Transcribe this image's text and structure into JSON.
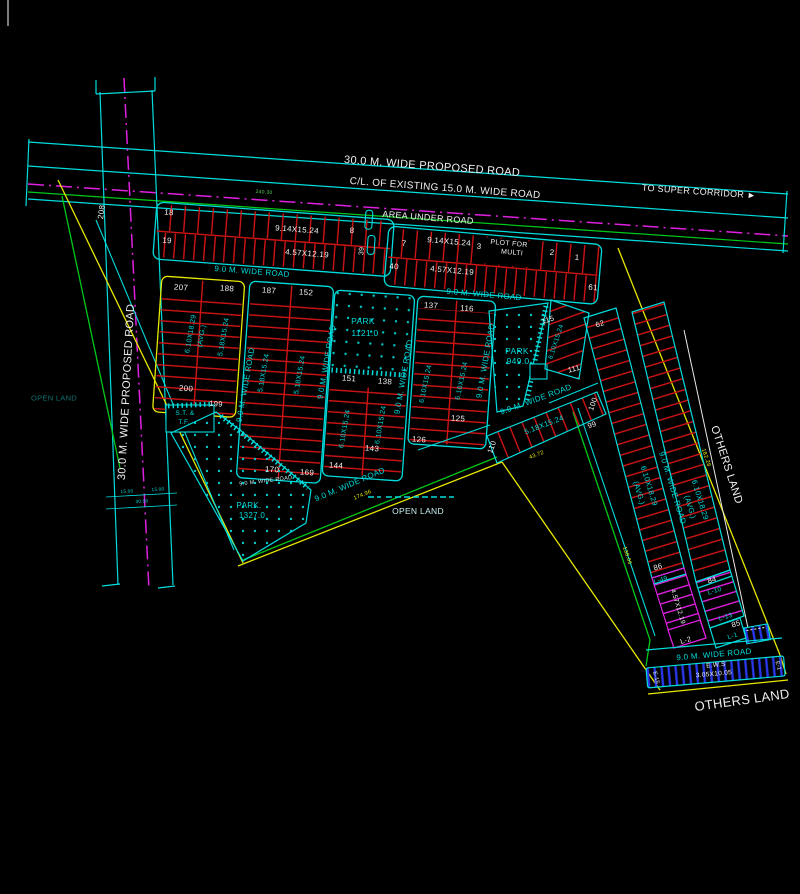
{
  "canvas": {
    "width": 800,
    "height": 894,
    "background": "#000000"
  },
  "colors": {
    "cyan": "#00dcdc",
    "red": "#d01414",
    "yellow": "#e8e800",
    "green": "#00c818",
    "magenta": "#e020e0",
    "blue": "#2838e8",
    "white": "#f0f0f0",
    "pale_cyan": "#c8f0f0",
    "dim_teal": "#127272",
    "dim_green": "#50d050"
  },
  "labels": [
    {
      "name": "road-proposed-label",
      "text": "30.0 M. WIDE PROPOSED ROAD",
      "x": 432,
      "y": 167,
      "rot": 4.3,
      "size": 11,
      "color": "#f0f0f0"
    },
    {
      "name": "road-existing-label",
      "text": "C/L. OF EXISTING 15.0 M. WIDE ROAD",
      "x": 445,
      "y": 189,
      "rot": 4.3,
      "size": 10,
      "color": "#f0f0f0"
    },
    {
      "name": "to-super-corridor-label",
      "text": "TO SUPER CORRIDOR ►",
      "x": 699,
      "y": 192,
      "rot": 4,
      "size": 9,
      "color": "#f0f0f0"
    },
    {
      "name": "dim-240-30",
      "text": "240.30",
      "x": 264,
      "y": 193,
      "rot": 4,
      "size": 5,
      "color": "#50d050"
    },
    {
      "name": "plot-208",
      "text": "208",
      "x": 102,
      "y": 212,
      "rot": -82,
      "size": 8,
      "color": "#f0f0f0"
    },
    {
      "name": "area-under-road-label",
      "text": "AREA UNDER ROAD",
      "x": 428,
      "y": 218,
      "rot": 4.5,
      "size": 9,
      "color": "#f0f0f0"
    },
    {
      "name": "plot-18",
      "text": "18",
      "x": 169,
      "y": 213,
      "rot": 4,
      "size": 8,
      "color": "#f0f0f0"
    },
    {
      "name": "plot-19",
      "text": "19",
      "x": 167,
      "y": 241,
      "rot": 4,
      "size": 8,
      "color": "#f0f0f0"
    },
    {
      "name": "dim-914x1524-a",
      "text": "9.14X15.24",
      "x": 297,
      "y": 230,
      "rot": 4.3,
      "size": 8,
      "color": "#f0f0f0"
    },
    {
      "name": "dim-457x1219-a",
      "text": "4.57X12.19",
      "x": 307,
      "y": 254,
      "rot": 4.3,
      "size": 8,
      "color": "#f0f0f0"
    },
    {
      "name": "plot-8",
      "text": "8",
      "x": 352,
      "y": 231,
      "rot": 4,
      "size": 8,
      "color": "#f0f0f0"
    },
    {
      "name": "plot-39",
      "text": "39",
      "x": 362,
      "y": 251,
      "rot": -86,
      "size": 7,
      "color": "#f0f0f0"
    },
    {
      "name": "road-90-tl",
      "text": "9.0 M. WIDE ROAD",
      "x": 252,
      "y": 272,
      "rot": 4.5,
      "size": 8,
      "color": "#00dcdc"
    },
    {
      "name": "plot-7",
      "text": "7",
      "x": 404,
      "y": 244,
      "rot": 5,
      "size": 8,
      "color": "#f0f0f0"
    },
    {
      "name": "dim-914x1524-b",
      "text": "9.14X15.24",
      "x": 449,
      "y": 242,
      "rot": 5,
      "size": 8,
      "color": "#f0f0f0"
    },
    {
      "name": "plot-3",
      "text": "3",
      "x": 479,
      "y": 247,
      "rot": 5,
      "size": 8,
      "color": "#f0f0f0"
    },
    {
      "name": "plot-for-multi-line1",
      "text": "PLOT FOR",
      "x": 509,
      "y": 244,
      "rot": 5,
      "size": 7,
      "color": "#f0f0f0"
    },
    {
      "name": "plot-for-multi-line2",
      "text": "MULTI",
      "x": 512,
      "y": 253,
      "rot": 5,
      "size": 7,
      "color": "#f0f0f0"
    },
    {
      "name": "plot-2",
      "text": "2",
      "x": 552,
      "y": 253,
      "rot": 5,
      "size": 8,
      "color": "#f0f0f0"
    },
    {
      "name": "plot-1",
      "text": "1",
      "x": 577,
      "y": 258,
      "rot": 5,
      "size": 8,
      "color": "#f0f0f0"
    },
    {
      "name": "plot-40",
      "text": "40",
      "x": 394,
      "y": 267,
      "rot": 5,
      "size": 8,
      "color": "#f0f0f0"
    },
    {
      "name": "dim-457x1219-b",
      "text": "4.57X12.19",
      "x": 452,
      "y": 271,
      "rot": 5,
      "size": 8,
      "color": "#f0f0f0"
    },
    {
      "name": "plot-61",
      "text": "61",
      "x": 593,
      "y": 288,
      "rot": 5,
      "size": 8,
      "color": "#f0f0f0"
    },
    {
      "name": "road-90-tr",
      "text": "9.0 M. WIDE ROAD",
      "x": 484,
      "y": 295,
      "rot": 5,
      "size": 8,
      "color": "#00dcdc"
    },
    {
      "name": "road-proposed-left-label",
      "text": "30.0 M. WIDE PROPOSED ROAD",
      "x": 127,
      "y": 392,
      "rot": -87,
      "size": 11,
      "color": "#f0f0f0"
    },
    {
      "name": "open-land-left-label",
      "text": "OPEN LAND",
      "x": 54,
      "y": 398,
      "rot": 0,
      "size": 7.5,
      "color": "#127272"
    },
    {
      "name": "dim-15-00-a",
      "text": "15.00",
      "x": 127,
      "y": 492,
      "rot": -3,
      "size": 4.5,
      "color": "#00dcdc"
    },
    {
      "name": "dim-15-00-b",
      "text": "15.00",
      "x": 158,
      "y": 490,
      "rot": -3,
      "size": 4.5,
      "color": "#00dcdc"
    },
    {
      "name": "dim-30-00",
      "text": "30.00",
      "x": 142,
      "y": 502,
      "rot": -3,
      "size": 4.5,
      "color": "#00dcdc"
    },
    {
      "name": "plot-207",
      "text": "207",
      "x": 181,
      "y": 288,
      "rot": 4,
      "size": 8,
      "color": "#f0f0f0"
    },
    {
      "name": "plot-188",
      "text": "188",
      "x": 227,
      "y": 289,
      "rot": 4,
      "size": 8,
      "color": "#f0f0f0"
    },
    {
      "name": "dim-610x1829-a1",
      "text": "6.10X18.29",
      "x": 191,
      "y": 334,
      "rot": -80,
      "size": 7,
      "color": "#00dcdc"
    },
    {
      "name": "dim-610x1829-a2",
      "text": "(AVG.)",
      "x": 202,
      "y": 336,
      "rot": -80,
      "size": 7,
      "color": "#00dcdc"
    },
    {
      "name": "dim-518x1524-a",
      "text": "5.18X15.24",
      "x": 224,
      "y": 337,
      "rot": -80,
      "size": 7,
      "color": "#00dcdc"
    },
    {
      "name": "plot-200",
      "text": "200",
      "x": 186,
      "y": 389,
      "rot": 4,
      "size": 8,
      "color": "#f0f0f0"
    },
    {
      "name": "plot-199",
      "text": "199",
      "x": 216,
      "y": 404,
      "rot": 4,
      "size": 7.5,
      "color": "#f0f0f0"
    },
    {
      "name": "st-tf-line1",
      "text": "S.T. &",
      "x": 185,
      "y": 414,
      "rot": 0,
      "size": 6.5,
      "color": "#00dcdc"
    },
    {
      "name": "st-tf-line2",
      "text": "T.F.",
      "x": 184,
      "y": 423,
      "rot": 0,
      "size": 6.5,
      "color": "#00dcdc"
    },
    {
      "name": "road-90-ab",
      "text": "9.0 M. WIDE ROAD",
      "x": 246,
      "y": 385,
      "rot": -80,
      "size": 8,
      "color": "#00dcdc"
    },
    {
      "name": "plot-187",
      "text": "187",
      "x": 269,
      "y": 291,
      "rot": 4,
      "size": 8,
      "color": "#f0f0f0"
    },
    {
      "name": "plot-152",
      "text": "152",
      "x": 306,
      "y": 293,
      "rot": 4,
      "size": 8,
      "color": "#f0f0f0"
    },
    {
      "name": "dim-518x1524-b1",
      "text": "5.18X15.24",
      "x": 264,
      "y": 373,
      "rot": -80,
      "size": 7,
      "color": "#00dcdc"
    },
    {
      "name": "dim-518x1524-b2",
      "text": "5.18X15.24",
      "x": 300,
      "y": 375,
      "rot": -80,
      "size": 7,
      "color": "#00dcdc"
    },
    {
      "name": "plot-170",
      "text": "170",
      "x": 272,
      "y": 470,
      "rot": 4,
      "size": 8,
      "color": "#f0f0f0"
    },
    {
      "name": "plot-169",
      "text": "169",
      "x": 307,
      "y": 473,
      "rot": 4,
      "size": 8,
      "color": "#f0f0f0"
    },
    {
      "name": "road-90-bc",
      "text": "9.0 M. WIDE ROAD",
      "x": 327,
      "y": 362,
      "rot": -80,
      "size": 8,
      "color": "#00dcdc"
    },
    {
      "name": "park-1121-label",
      "text": "PARK",
      "x": 363,
      "y": 321,
      "rot": 0,
      "size": 8.5,
      "color": "#00dcdc"
    },
    {
      "name": "park-1121-area",
      "text": "1121.0",
      "x": 365,
      "y": 333,
      "rot": 0,
      "size": 8.5,
      "color": "#00dcdc"
    },
    {
      "name": "plot-151",
      "text": "151",
      "x": 349,
      "y": 379,
      "rot": 4,
      "size": 8,
      "color": "#f0f0f0"
    },
    {
      "name": "plot-138",
      "text": "138",
      "x": 385,
      "y": 382,
      "rot": 4,
      "size": 8,
      "color": "#f0f0f0"
    },
    {
      "name": "dim-610x1524-c1",
      "text": "6.10X15.24",
      "x": 345,
      "y": 429,
      "rot": -80,
      "size": 7,
      "color": "#00dcdc"
    },
    {
      "name": "dim-610x1524-c2",
      "text": "6.10X15.24",
      "x": 381,
      "y": 425,
      "rot": -80,
      "size": 7,
      "color": "#00dcdc"
    },
    {
      "name": "plot-144",
      "text": "144",
      "x": 336,
      "y": 466,
      "rot": 4,
      "size": 8,
      "color": "#f0f0f0"
    },
    {
      "name": "plot-143",
      "text": "143",
      "x": 372,
      "y": 449,
      "rot": 4,
      "size": 8,
      "color": "#f0f0f0"
    },
    {
      "name": "road-90-cd",
      "text": "9.0 M. WIDE ROAD",
      "x": 404,
      "y": 377,
      "rot": -80,
      "size": 8,
      "color": "#00dcdc"
    },
    {
      "name": "plot-137",
      "text": "137",
      "x": 431,
      "y": 306,
      "rot": 4,
      "size": 8,
      "color": "#f0f0f0"
    },
    {
      "name": "plot-116",
      "text": "116",
      "x": 467,
      "y": 309,
      "rot": 4,
      "size": 8,
      "color": "#f0f0f0"
    },
    {
      "name": "dim-610x1524-d1",
      "text": "6.10X15.24",
      "x": 426,
      "y": 384,
      "rot": -78,
      "size": 7,
      "color": "#00dcdc"
    },
    {
      "name": "dim-610x1524-d2",
      "text": "6.10X15.24",
      "x": 462,
      "y": 381,
      "rot": -78,
      "size": 7,
      "color": "#00dcdc"
    },
    {
      "name": "plot-126",
      "text": "126",
      "x": 419,
      "y": 440,
      "rot": 4,
      "size": 8,
      "color": "#f0f0f0"
    },
    {
      "name": "plot-125",
      "text": "125",
      "x": 458,
      "y": 419,
      "rot": 4,
      "size": 8,
      "color": "#f0f0f0"
    },
    {
      "name": "road-90-de",
      "text": "9.0 M. WIDE ROAD",
      "x": 486,
      "y": 361,
      "rot": -80,
      "size": 8,
      "color": "#00dcdc"
    },
    {
      "name": "park-949-label",
      "text": "PARK",
      "x": 517,
      "y": 351,
      "rot": 0,
      "size": 8.5,
      "color": "#00dcdc"
    },
    {
      "name": "park-949-area",
      "text": "949.0",
      "x": 518,
      "y": 361,
      "rot": 0,
      "size": 8.5,
      "color": "#00dcdc"
    },
    {
      "name": "plot-115",
      "text": "115",
      "x": 548,
      "y": 320,
      "rot": -18,
      "size": 7.5,
      "color": "#f0f0f0"
    },
    {
      "name": "dim-610x1524-f",
      "text": "6.10X15.24",
      "x": 557,
      "y": 342,
      "rot": -72,
      "size": 6.5,
      "color": "#00dcdc"
    },
    {
      "name": "plot-111",
      "text": "111",
      "x": 574,
      "y": 369,
      "rot": -15,
      "size": 7.5,
      "color": "#f0f0f0"
    },
    {
      "name": "road-90-park-diag",
      "text": "9.0 M. WIDE ROAD",
      "x": 536,
      "y": 400,
      "rot": -20,
      "size": 8,
      "color": "#00dcdc"
    },
    {
      "name": "plot-110",
      "text": "110",
      "x": 492,
      "y": 447,
      "rot": -70,
      "size": 7.5,
      "color": "#f0f0f0"
    },
    {
      "name": "dim-518x1524-g",
      "text": "5.18X15.24",
      "x": 544,
      "y": 425,
      "rot": -21,
      "size": 7.5,
      "color": "#00dcdc"
    },
    {
      "name": "plot-100",
      "text": "100",
      "x": 593,
      "y": 404,
      "rot": -70,
      "size": 7.5,
      "color": "#f0f0f0"
    },
    {
      "name": "plot-99",
      "text": "99",
      "x": 592,
      "y": 425,
      "rot": -20,
      "size": 7.5,
      "color": "#f0f0f0"
    },
    {
      "name": "dim-43-72",
      "text": "43.72",
      "x": 537,
      "y": 456,
      "rot": -21,
      "size": 5.5,
      "color": "#e8e800"
    },
    {
      "name": "road-90-bottom-diag",
      "text": "9.0 M. WIDE ROAD",
      "x": 350,
      "y": 485,
      "rot": -23,
      "size": 8,
      "color": "#00dcdc"
    },
    {
      "name": "road-90-b-bottom",
      "text": "9.0 M. WIDE ROAD",
      "x": 266,
      "y": 482,
      "rot": -7,
      "size": 5.5,
      "color": "#c8f0f0"
    },
    {
      "name": "park-1327-label",
      "text": "PARK.",
      "x": 249,
      "y": 506,
      "rot": 0,
      "size": 8,
      "color": "#00dcdc"
    },
    {
      "name": "park-1327-area",
      "text": "1327.0",
      "x": 252,
      "y": 516,
      "rot": 0,
      "size": 8,
      "color": "#00dcdc"
    },
    {
      "name": "dim-174-96",
      "text": "174.96",
      "x": 363,
      "y": 496,
      "rot": -23,
      "size": 5.5,
      "color": "#e8e800"
    },
    {
      "name": "open-land-center-label",
      "text": "OPEN LAND",
      "x": 418,
      "y": 511,
      "rot": 0,
      "size": 8.5,
      "color": "#c8f0f0"
    },
    {
      "name": "plot-62",
      "text": "62",
      "x": 600,
      "y": 324,
      "rot": -17,
      "size": 7.5,
      "color": "#f0f0f0"
    },
    {
      "name": "dim-610x1829-arm1",
      "text": "6.10X18.29",
      "x": 649,
      "y": 486,
      "rot": 73,
      "size": 7.5,
      "color": "#00dcdc"
    },
    {
      "name": "dim-610x1829-arm1b",
      "text": "(AVG.)",
      "x": 639,
      "y": 493,
      "rot": 73,
      "size": 7.5,
      "color": "#00dcdc"
    },
    {
      "name": "road-90-arm",
      "text": "9.0 M. WIDE ROAD",
      "x": 672,
      "y": 488,
      "rot": 73,
      "size": 8,
      "color": "#00dcdc"
    },
    {
      "name": "dim-610x1829-arm2",
      "text": "6.10X18.29",
      "x": 700,
      "y": 500,
      "rot": 73,
      "size": 7.5,
      "color": "#00dcdc"
    },
    {
      "name": "dim-610x1829-arm2b",
      "text": "(AVG.)",
      "x": 690,
      "y": 507,
      "rot": 73,
      "size": 7.5,
      "color": "#00dcdc"
    },
    {
      "name": "others-land-right-label",
      "text": "OTHERS LAND",
      "x": 726,
      "y": 465,
      "rot": 72,
      "size": 11,
      "color": "#f0f0f0"
    },
    {
      "name": "dim-182-28",
      "text": "182.28",
      "x": 705,
      "y": 458,
      "rot": 72,
      "size": 5.5,
      "color": "#e8e800"
    },
    {
      "name": "dim-138-06",
      "text": "138.06",
      "x": 626,
      "y": 556,
      "rot": 72,
      "size": 5.5,
      "color": "#e8e800"
    },
    {
      "name": "plot-86",
      "text": "86",
      "x": 658,
      "y": 567,
      "rot": -17,
      "size": 7.5,
      "color": "#f0f0f0"
    },
    {
      "name": "plot-l49",
      "text": "L-49",
      "x": 661,
      "y": 581,
      "rot": -17,
      "size": 6.5,
      "color": "#00dcdc"
    },
    {
      "name": "dim-457x1219-l",
      "text": "4.57X12.19",
      "x": 677,
      "y": 607,
      "rot": 73,
      "size": 6.5,
      "color": "#f0f0f0"
    },
    {
      "name": "plot-l2",
      "text": "L-2",
      "x": 686,
      "y": 641,
      "rot": -17,
      "size": 7,
      "color": "#f0f0f0"
    },
    {
      "name": "plot-84",
      "text": "84",
      "x": 712,
      "y": 580,
      "rot": -17,
      "size": 7.5,
      "color": "#f0f0f0"
    },
    {
      "name": "plot-l10",
      "text": "L-10",
      "x": 715,
      "y": 592,
      "rot": -17,
      "size": 6.5,
      "color": "#00dcdc"
    },
    {
      "name": "plot-l13",
      "text": "L-13",
      "x": 726,
      "y": 618,
      "rot": -17,
      "size": 6.5,
      "color": "#00dcdc"
    },
    {
      "name": "plot-85",
      "text": "85",
      "x": 736,
      "y": 624,
      "rot": -17,
      "size": 7.5,
      "color": "#f0f0f0"
    },
    {
      "name": "plot-l1",
      "text": "L-1",
      "x": 733,
      "y": 637,
      "rot": -17,
      "size": 6.5,
      "color": "#00dcdc"
    },
    {
      "name": "road-90-ews",
      "text": "9.0 M. WIDE ROAD",
      "x": 714,
      "y": 655,
      "rot": -5,
      "size": 8,
      "color": "#00dcdc"
    },
    {
      "name": "ews-label",
      "text": "E.W.S",
      "x": 716,
      "y": 666,
      "rot": -5,
      "size": 6.5,
      "color": "#f0f0f0"
    },
    {
      "name": "ews-dim",
      "text": "3.05X10.05",
      "x": 714,
      "y": 675,
      "rot": -5,
      "size": 6.5,
      "color": "#f0f0f0"
    },
    {
      "name": "plot-e15",
      "text": "E-15",
      "x": 655,
      "y": 678,
      "rot": 75,
      "size": 5.5,
      "color": "#f0f0f0"
    },
    {
      "name": "plot-e1",
      "text": "E-1",
      "x": 777,
      "y": 666,
      "rot": 75,
      "size": 5.5,
      "color": "#f0f0f0"
    },
    {
      "name": "others-land-bottom-label",
      "text": "OTHERS LAND",
      "x": 742,
      "y": 700,
      "rot": -8,
      "size": 13,
      "color": "#f0f0f0"
    }
  ]
}
